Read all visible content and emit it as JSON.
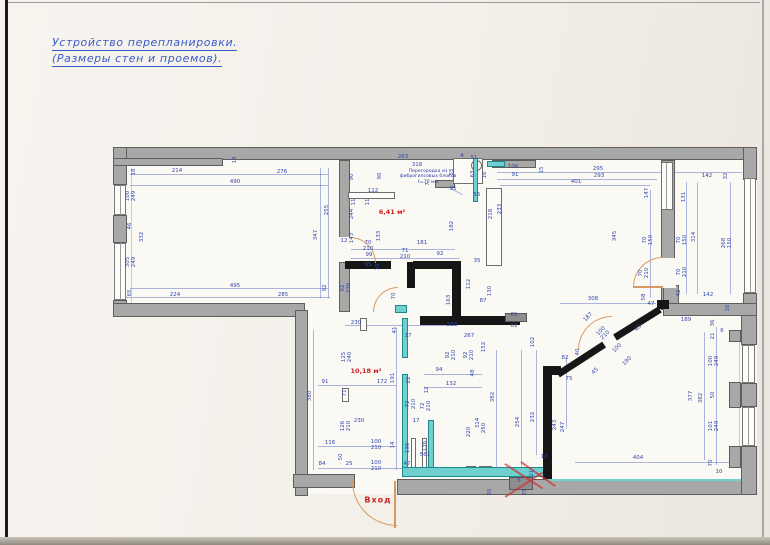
{
  "page": {
    "title_line1": "Устройство перепланировки.",
    "title_line2": "(Размеры стен и проемов).",
    "colors": {
      "title": "#3a5bc7",
      "dim_label": "#3347ad",
      "area_label": "#cc2222",
      "wall_gray": "#a8a8a8",
      "new_wall": "#161616",
      "teal_partition": "#6fd0cf",
      "door_arc": "#d89a5f",
      "paper": "#f3efe9"
    }
  },
  "plan": {
    "annotation": {
      "text": "Перегородка из\nфиброгипсовых блоков\nt=70 мм",
      "x": 428,
      "y": 177
    },
    "area_labels": [
      {
        "text": "6,41 м²",
        "x": 392,
        "y": 212,
        "cls": ""
      },
      {
        "text": "10,18 м²",
        "x": 366,
        "y": 371,
        "cls": ""
      },
      {
        "text": "Вход",
        "x": 378,
        "y": 500,
        "cls": "entr"
      }
    ],
    "rooms": [
      [
        113,
        147,
        644,
        170
      ],
      [
        295,
        308,
        462,
        186
      ]
    ],
    "walls_gray": [
      [
        113,
        147,
        644,
        13
      ],
      [
        113,
        147,
        14,
        38
      ],
      [
        113,
        215,
        14,
        28
      ],
      [
        113,
        300,
        14,
        17
      ],
      [
        113,
        303,
        192,
        14
      ],
      [
        295,
        310,
        13,
        186
      ],
      [
        293,
        474,
        62,
        14
      ],
      [
        397,
        479,
        360,
        16
      ],
      [
        743,
        147,
        14,
        33
      ],
      [
        743,
        293,
        14,
        27
      ],
      [
        741,
        310,
        16,
        35
      ],
      [
        741,
        383,
        16,
        24
      ],
      [
        741,
        446,
        16,
        49
      ],
      [
        729,
        330,
        12,
        12
      ],
      [
        729,
        382,
        12,
        26
      ],
      [
        729,
        446,
        12,
        22
      ],
      [
        661,
        160,
        14,
        150
      ],
      [
        663,
        285,
        16,
        30
      ],
      [
        663,
        303,
        94,
        13
      ],
      [
        339,
        160,
        11,
        78
      ],
      [
        339,
        262,
        11,
        50
      ],
      [
        113,
        158,
        110,
        8
      ],
      [
        492,
        160,
        44,
        8
      ],
      [
        435,
        180,
        20,
        8
      ]
    ],
    "walls_black": [
      [
        345,
        261,
        46,
        8
      ],
      [
        413,
        261,
        48,
        8
      ],
      [
        407,
        262,
        8,
        26
      ],
      [
        452,
        261,
        9,
        58
      ],
      [
        420,
        316,
        100,
        9
      ],
      [
        543,
        366,
        9,
        113
      ],
      [
        543,
        366,
        18,
        9
      ],
      [
        657,
        300,
        12,
        9
      ]
    ],
    "black_diag": [
      [
        558,
        371,
        55,
        -33
      ],
      [
        615,
        334,
        53,
        -32
      ]
    ],
    "walls_teal": [
      [
        473,
        158,
        5,
        44
      ],
      [
        487,
        161,
        18,
        6
      ],
      [
        402,
        318,
        6,
        40
      ],
      [
        402,
        374,
        6,
        100
      ],
      [
        428,
        420,
        6,
        54
      ],
      [
        402,
        467,
        145,
        10
      ],
      [
        395,
        305,
        12,
        8
      ]
    ],
    "teal_lines": [
      [
        547,
        479,
        194,
        2
      ]
    ],
    "thin_boxes": [
      [
        348,
        192,
        47,
        7
      ],
      [
        661,
        162,
        12,
        48
      ],
      [
        486,
        188,
        16,
        78
      ],
      [
        453,
        158,
        30,
        26
      ],
      [
        411,
        438,
        5,
        32
      ],
      [
        422,
        438,
        5,
        32
      ],
      [
        342,
        388,
        7,
        14
      ],
      [
        360,
        318,
        7,
        13
      ],
      [
        466,
        466,
        10,
        10
      ],
      [
        479,
        466,
        13,
        10
      ]
    ],
    "circles": [
      [
        471,
        160,
        11
      ]
    ],
    "windows": [
      [
        114,
        185,
        12,
        30
      ],
      [
        114,
        243,
        12,
        57
      ],
      [
        744,
        178,
        12,
        115
      ],
      [
        742,
        345,
        13,
        38
      ],
      [
        742,
        407,
        13,
        39
      ]
    ],
    "gaps": [
      [
        660,
        258,
        16,
        30
      ],
      [
        338,
        237,
        13,
        25
      ]
    ],
    "doors": [
      {
        "x": 352,
        "y": 481,
        "s": 45,
        "c": "bl"
      },
      {
        "x": 350,
        "y": 237,
        "s": 26,
        "c": "tr"
      },
      {
        "x": 633,
        "y": 257,
        "s": 30,
        "c": "tl"
      },
      {
        "x": 578,
        "y": 316,
        "s": 34,
        "c": "tl"
      },
      {
        "x": 373,
        "y": 287,
        "s": 25,
        "c": "tl"
      }
    ],
    "leafs": [
      [
        394,
        481,
        2,
        47
      ],
      [
        633,
        286,
        30,
        2
      ]
    ],
    "dim_lines": [
      [
        130,
        174,
        198,
        1
      ],
      [
        130,
        185,
        198,
        1
      ],
      [
        130,
        288,
        198,
        1
      ],
      [
        118,
        297,
        212,
        1
      ],
      [
        320,
        168,
        1,
        130
      ],
      [
        328,
        168,
        1,
        130
      ],
      [
        497,
        172,
        245,
        1
      ],
      [
        497,
        179,
        160,
        1
      ],
      [
        500,
        185,
        150,
        1
      ],
      [
        650,
        190,
        1,
        108
      ],
      [
        686,
        182,
        1,
        112
      ],
      [
        697,
        182,
        1,
        112
      ],
      [
        730,
        182,
        1,
        112
      ],
      [
        313,
        330,
        1,
        140
      ],
      [
        396,
        328,
        1,
        142
      ],
      [
        318,
        385,
        78,
        1
      ],
      [
        318,
        446,
        78,
        1
      ],
      [
        318,
        468,
        86,
        1
      ],
      [
        345,
        325,
        112,
        1
      ],
      [
        496,
        350,
        1,
        118
      ],
      [
        521,
        350,
        1,
        118
      ],
      [
        536,
        350,
        1,
        105
      ],
      [
        566,
        357,
        1,
        72
      ],
      [
        575,
        462,
        162,
        1
      ],
      [
        716,
        327,
        1,
        138
      ],
      [
        704,
        332,
        1,
        128
      ],
      [
        560,
        303,
        96,
        1
      ],
      [
        350,
        249,
        105,
        1
      ],
      [
        350,
        258,
        110,
        1
      ],
      [
        424,
        374,
        58,
        1
      ],
      [
        424,
        387,
        58,
        1
      ]
    ],
    "orange_lines": [
      [
        131,
        168,
        1,
        142
      ],
      [
        739,
        340,
        1,
        112
      ]
    ],
    "red_diag": [
      [
        505,
        463,
        45,
        33
      ],
      [
        505,
        496,
        45,
        -33
      ],
      [
        521,
        461,
        42,
        35
      ]
    ],
    "leader_diag": [
      [
        447,
        186,
        18,
        28
      ]
    ],
    "dims": [
      [
        "18",
        135,
        172,
        -90
      ],
      [
        "214",
        177,
        172,
        0
      ],
      [
        "276",
        282,
        173,
        0
      ],
      [
        "490",
        235,
        183,
        0
      ],
      [
        "100\n249",
        132,
        196,
        -90
      ],
      [
        "46",
        131,
        226,
        -90
      ],
      [
        "332",
        143,
        237,
        -90
      ],
      [
        "305\n249",
        132,
        262,
        -90
      ],
      [
        "65",
        131,
        293,
        -90
      ],
      [
        "255",
        328,
        210,
        -90
      ],
      [
        "347",
        317,
        235,
        -90
      ],
      [
        "495",
        235,
        287,
        0
      ],
      [
        "92",
        326,
        288,
        -90
      ],
      [
        "224",
        175,
        296,
        0
      ],
      [
        "285",
        283,
        296,
        0
      ],
      [
        "18",
        236,
        160,
        -90
      ],
      [
        "263",
        403,
        158,
        0
      ],
      [
        "318",
        417,
        166,
        0
      ],
      [
        "90",
        353,
        177,
        -90
      ],
      [
        "90",
        381,
        176,
        -90
      ],
      [
        "112",
        373,
        192,
        0
      ],
      [
        "11",
        355,
        202,
        -90
      ],
      [
        "244",
        353,
        214,
        -90
      ],
      [
        "11",
        369,
        202,
        -90
      ],
      [
        "143",
        353,
        238,
        -90
      ],
      [
        "133",
        380,
        236,
        -90
      ],
      [
        "70\n210",
        368,
        247,
        0
      ],
      [
        "99",
        369,
        256,
        0
      ],
      [
        "181",
        422,
        244,
        0
      ],
      [
        "182",
        453,
        226,
        -90
      ],
      [
        "71\n210",
        405,
        255,
        0
      ],
      [
        "92",
        440,
        255,
        0
      ],
      [
        "95",
        368,
        266,
        0
      ],
      [
        "10",
        379,
        267,
        -90
      ],
      [
        "62\n230",
        347,
        288,
        -90
      ],
      [
        "70",
        395,
        296,
        -90
      ],
      [
        "12",
        344,
        242,
        0
      ],
      [
        "7",
        429,
        184,
        -90
      ],
      [
        "4",
        462,
        157,
        0
      ],
      [
        "51",
        474,
        159,
        0
      ],
      [
        "63",
        474,
        174,
        -90
      ],
      [
        "16",
        486,
        175,
        -90
      ],
      [
        "55",
        453,
        172,
        -90
      ],
      [
        "35",
        453,
        190,
        0
      ],
      [
        "55",
        477,
        196,
        0
      ],
      [
        "218",
        492,
        214,
        -90
      ],
      [
        "233",
        501,
        209,
        -90
      ],
      [
        "35",
        477,
        262,
        0
      ],
      [
        "106",
        513,
        168,
        0
      ],
      [
        "91",
        515,
        176,
        0
      ],
      [
        "15",
        543,
        170,
        -90
      ],
      [
        "295",
        598,
        170,
        0
      ],
      [
        "293",
        599,
        177,
        0
      ],
      [
        "401",
        576,
        183,
        0
      ],
      [
        "147",
        648,
        193,
        -90
      ],
      [
        "345",
        616,
        236,
        -90
      ],
      [
        "70\n150",
        649,
        240,
        -90
      ],
      [
        "70\n210",
        645,
        273,
        -90
      ],
      [
        "130",
        491,
        291,
        -90
      ],
      [
        "308",
        593,
        300,
        0
      ],
      [
        "58",
        645,
        297,
        -90
      ],
      [
        "47",
        651,
        305,
        0
      ],
      [
        "87",
        483,
        302,
        0
      ],
      [
        "112",
        470,
        284,
        -90
      ],
      [
        "163",
        450,
        300,
        -90
      ],
      [
        "61",
        514,
        316,
        0
      ],
      [
        "61",
        514,
        327,
        0
      ],
      [
        "223",
        452,
        326,
        0
      ],
      [
        "267",
        469,
        337,
        0
      ],
      [
        "102",
        534,
        342,
        -90
      ],
      [
        "142",
        707,
        177,
        0
      ],
      [
        "32",
        727,
        176,
        -90
      ],
      [
        "131",
        685,
        197,
        -90
      ],
      [
        "70\n150",
        683,
        240,
        -90
      ],
      [
        "314",
        695,
        237,
        -90
      ],
      [
        "268\n150",
        728,
        243,
        -90
      ],
      [
        "70\n210",
        683,
        272,
        -90
      ],
      [
        "42",
        680,
        293,
        -90
      ],
      [
        "142",
        708,
        296,
        0
      ],
      [
        "16",
        729,
        308,
        -90
      ],
      [
        "189",
        686,
        321,
        0
      ],
      [
        "230",
        356,
        324,
        0
      ],
      [
        "41",
        396,
        330,
        -90
      ],
      [
        "125\n240",
        348,
        357,
        -90
      ],
      [
        "191",
        394,
        378,
        -90
      ],
      [
        "91",
        325,
        383,
        0
      ],
      [
        "172",
        382,
        383,
        0
      ],
      [
        "380",
        311,
        396,
        -90
      ],
      [
        "71",
        346,
        393,
        -90
      ],
      [
        "230",
        359,
        422,
        0
      ],
      [
        "126\n210",
        347,
        426,
        -90
      ],
      [
        "116",
        330,
        444,
        0
      ],
      [
        "100\n210",
        376,
        446,
        0
      ],
      [
        "14",
        394,
        445,
        -90
      ],
      [
        "84",
        322,
        465,
        0
      ],
      [
        "25",
        349,
        465,
        0
      ],
      [
        "100\n210",
        376,
        467,
        0
      ],
      [
        "50",
        342,
        457,
        -90
      ],
      [
        "47",
        407,
        465,
        0
      ],
      [
        "136",
        409,
        448,
        -90
      ],
      [
        "561",
        425,
        456,
        0
      ],
      [
        "136",
        426,
        446,
        -90
      ],
      [
        "22",
        410,
        380,
        -90
      ],
      [
        "72\n210",
        412,
        404,
        -90
      ],
      [
        "72\n210",
        427,
        406,
        -90
      ],
      [
        "94",
        439,
        371,
        0
      ],
      [
        "132",
        451,
        385,
        0
      ],
      [
        "12",
        428,
        390,
        -90
      ],
      [
        "92\n210",
        452,
        355,
        -90
      ],
      [
        "92\n210",
        470,
        355,
        -90
      ],
      [
        "152",
        485,
        347,
        -90
      ],
      [
        "48",
        474,
        373,
        -90
      ],
      [
        "382",
        494,
        397,
        -90
      ],
      [
        "314",
        479,
        423,
        -90
      ],
      [
        "220",
        470,
        432,
        -90
      ],
      [
        "250",
        485,
        428,
        -90
      ],
      [
        "254",
        519,
        422,
        -90
      ],
      [
        "232",
        534,
        417,
        -90
      ],
      [
        "17",
        416,
        422,
        0
      ],
      [
        "17",
        408,
        337,
        0
      ],
      [
        "12",
        544,
        458,
        0
      ],
      [
        "21",
        533,
        473,
        -90
      ],
      [
        "5",
        519,
        482,
        0
      ],
      [
        "25",
        491,
        492,
        -90
      ],
      [
        "25",
        526,
        492,
        -90
      ],
      [
        "82",
        565,
        359,
        0
      ],
      [
        "40",
        579,
        352,
        -90
      ],
      [
        "75",
        569,
        380,
        0
      ],
      [
        "45",
        596,
        372,
        -46
      ],
      [
        "187",
        589,
        318,
        -46
      ],
      [
        "100\n210",
        604,
        334,
        -46
      ],
      [
        "45",
        639,
        329,
        -46
      ],
      [
        "100",
        618,
        349,
        -46
      ],
      [
        "190",
        628,
        362,
        -46
      ],
      [
        "243",
        556,
        425,
        -90
      ],
      [
        "247",
        564,
        427,
        -90
      ],
      [
        "36",
        714,
        323,
        -90
      ],
      [
        "21",
        714,
        336,
        -90
      ],
      [
        "6",
        722,
        332,
        0
      ],
      [
        "100\n249",
        715,
        361,
        -90
      ],
      [
        "50",
        714,
        395,
        -90
      ],
      [
        "377",
        692,
        396,
        -90
      ],
      [
        "382",
        702,
        398,
        -90
      ],
      [
        "101\n249",
        715,
        426,
        -90
      ],
      [
        "70",
        712,
        463,
        -90
      ],
      [
        "10",
        719,
        473,
        0
      ],
      [
        "404",
        638,
        459,
        0
      ]
    ],
    "chips": [
      [
        509,
        477,
        24,
        13
      ],
      [
        505,
        313,
        22,
        9
      ]
    ],
    "closet_lines": [
      [
        666,
        163,
        1,
        46
      ]
    ]
  }
}
